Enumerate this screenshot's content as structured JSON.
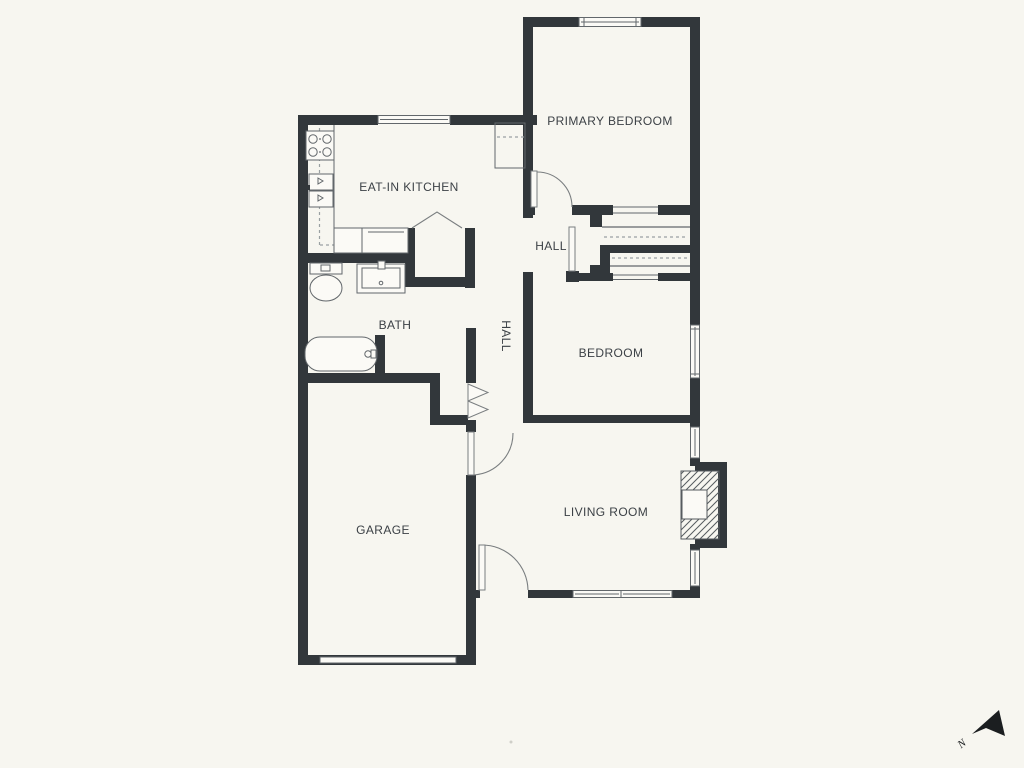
{
  "colors": {
    "bg": "#f7f6f0",
    "wall": "#32373b",
    "line": "#62676b",
    "line-light": "#9aa0a2",
    "text": "#3c4146",
    "compass": "#1b1e20"
  },
  "rooms": {
    "primary_bedroom": {
      "label": "PRIMARY BEDROOM"
    },
    "eat_in_kitchen": {
      "label": "EAT-IN KITCHEN"
    },
    "hall_upper": {
      "label": "HALL"
    },
    "hall_corridor": {
      "label": "HALL"
    },
    "bath": {
      "label": "BATH"
    },
    "bedroom": {
      "label": "BEDROOM"
    },
    "garage": {
      "label": "GARAGE"
    },
    "living_room": {
      "label": "LIVING ROOM"
    }
  },
  "compass": {
    "label": "N"
  },
  "fixtures": [
    "stove-icon",
    "kitchen-sink-icon",
    "dishwasher-icon",
    "pantry-shelf-icon",
    "toilet-icon",
    "vanity-sink-icon",
    "bathtub-icon",
    "fireplace-icon",
    "garage-door-icon",
    "bifold-closet-door-icon",
    "closet-rod-icon",
    "door-swing-icon",
    "window-icon"
  ]
}
